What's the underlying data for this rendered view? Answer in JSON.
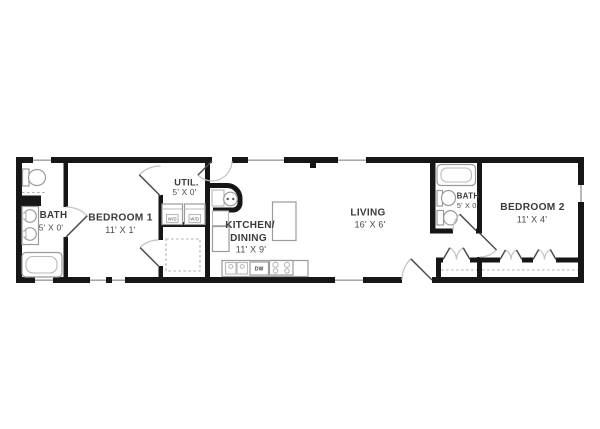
{
  "floorplan": {
    "rooms": {
      "bathLeft": {
        "name": "BATH",
        "dims": "5' X 0'"
      },
      "bedroom1": {
        "name": "BEDROOM 1",
        "dims": "11' X 1'"
      },
      "util": {
        "name": "UTIL.",
        "dims": "5' X 0'"
      },
      "kitchen": {
        "line1": "KITCHEN/",
        "line2": "DINING",
        "dims": "11' X 9'"
      },
      "living": {
        "name": "LIVING",
        "dims": "16' X 6'"
      },
      "bathRight": {
        "name": "BATH",
        "dims": "5' X 0'"
      },
      "bedroom2": {
        "name": "BEDROOM 2",
        "dims": "11' X 4'"
      }
    },
    "appliances": {
      "washer": "W/D",
      "dryer": "W/D",
      "dishwasher": "DW"
    },
    "colors": {
      "background": "#ffffff",
      "walls": "#161616",
      "fixtures": "#9b9b9b",
      "labels": "#3b3b3b"
    }
  }
}
